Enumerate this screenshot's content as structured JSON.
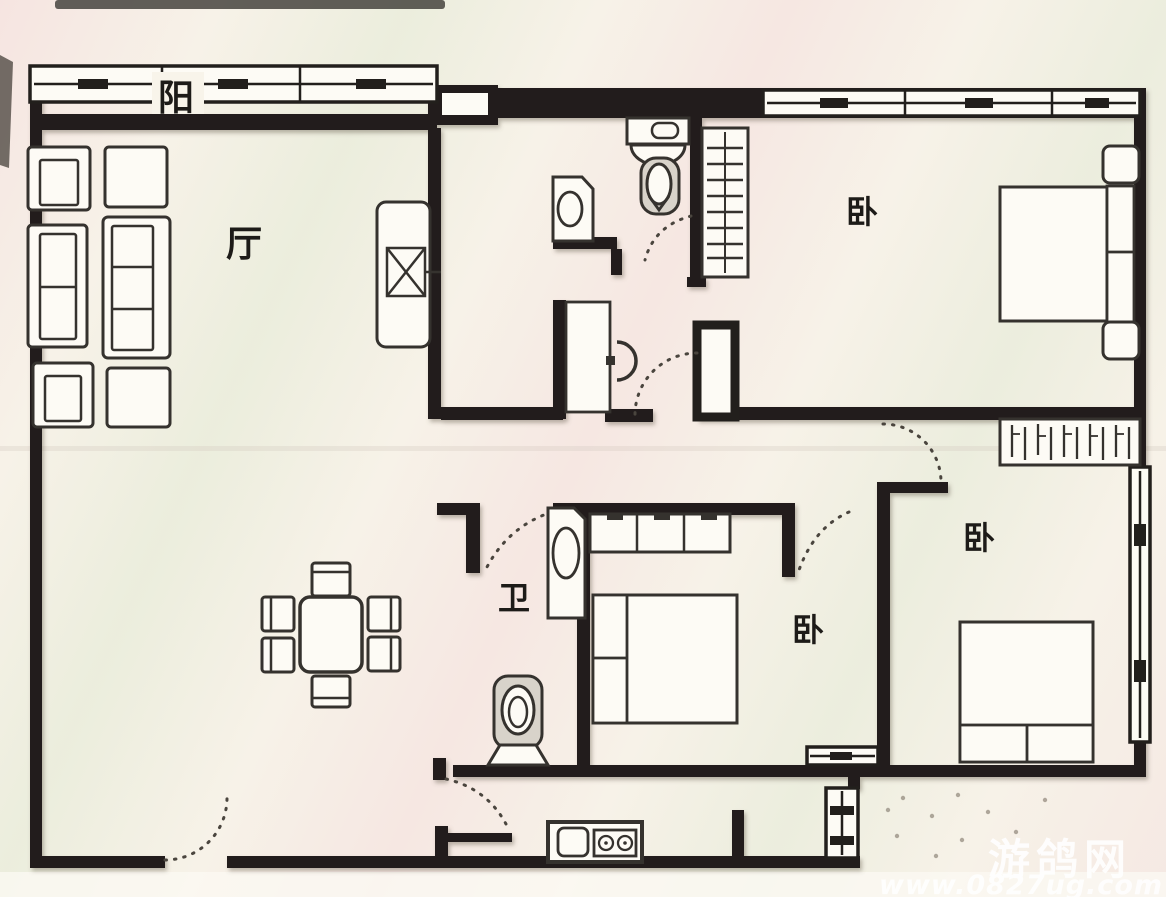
{
  "plan": {
    "room_labels": {
      "balcony": "阳",
      "living_room": "厅",
      "bedroom_top": "卧",
      "bedroom_middle": "卧",
      "bedroom_bottom_right": "卧",
      "bathroom": "卫"
    },
    "colors": {
      "walls": "#221f1c",
      "furniture_lines": "#35322e",
      "paper": "#f6f1e8",
      "watermark_text": "#ffffff"
    }
  },
  "watermark": {
    "site_name": "游鸽网",
    "site_url": "www.0827ug.com"
  }
}
